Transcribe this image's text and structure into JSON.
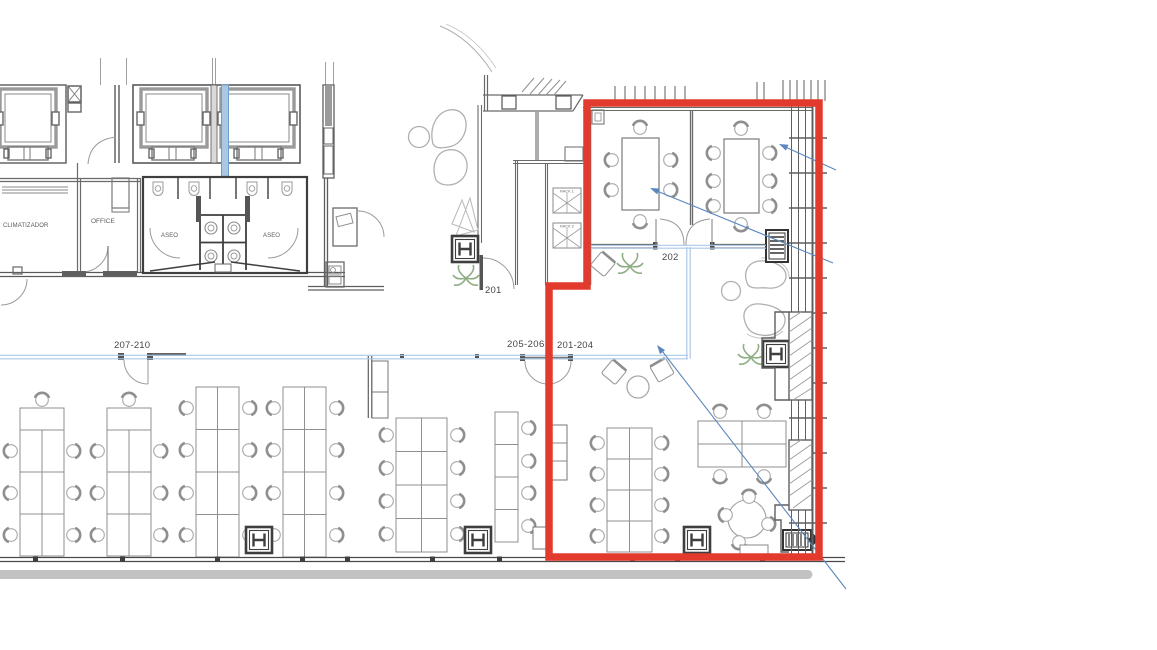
{
  "labels": {
    "room_climatizador": "CLIMATIZADOR",
    "room_office": "OFFICE",
    "room_aseo_left": "ASEO",
    "room_aseo_right": "ASEO",
    "rack_1": "RACK 1",
    "rack_2": "RACK 2",
    "door_201": "201",
    "door_202": "202",
    "zone_207_210": "207-210",
    "zone_205_206": "205-206",
    "zone_201_204": "201-204"
  },
  "colors": {
    "highlight_outline": "#e23b2e",
    "corridor_line": "#abc8e6",
    "leader_arrow": "#5b87bf",
    "riser_fill": "#aac7e4",
    "plant_green": "#8fae85",
    "walkway_band": "#c2c2c2"
  }
}
